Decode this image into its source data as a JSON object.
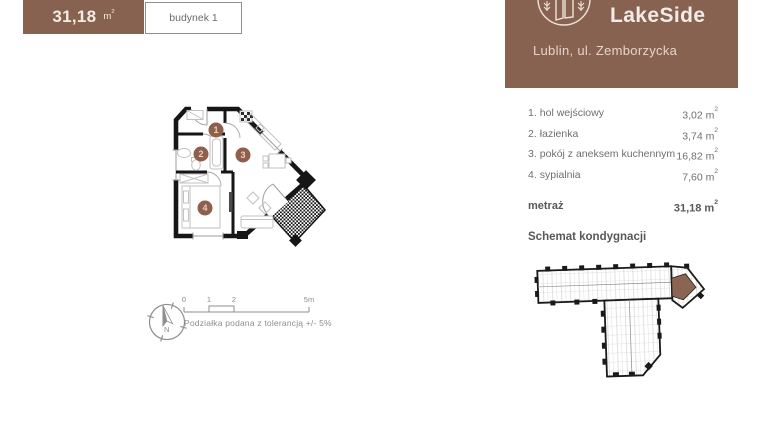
{
  "summary": {
    "area_value": "31,18",
    "unit_base": "m",
    "unit_sup": "2",
    "building_label": "budynek 1"
  },
  "brand": {
    "name": "LakeSide",
    "address": "Lublin, ul. Zemborzycka",
    "logo_icon": "building-with-trees-logo",
    "bg_color": "#876250"
  },
  "rooms": {
    "unit_base": "m",
    "unit_sup": "2",
    "items": [
      {
        "no": "1.",
        "name": "hol wejściowy",
        "area": "3,02"
      },
      {
        "no": "2.",
        "name": "łazienka",
        "area": "3,74"
      },
      {
        "no": "3.",
        "name": "pokój z aneksem kuchennym",
        "area": "16,82"
      },
      {
        "no": "4.",
        "name": "sypialnia",
        "area": "7,60"
      }
    ]
  },
  "total": {
    "label": "metraż",
    "area": "31,18",
    "unit_base": "m",
    "unit_sup": "2"
  },
  "schematic": {
    "title": "Schemat kondygnacji",
    "highlight_color": "#8a6552"
  },
  "floorplan": {
    "markers": [
      "1",
      "2",
      "3",
      "4"
    ],
    "marker_color": "#8d5f4c",
    "scale": {
      "tick_0": "0",
      "tick_1": "1",
      "tick_2": "2",
      "tick_end": "5m",
      "note": "Podziałka podana z tolerancją +/- 5%"
    },
    "compass_label": "N"
  },
  "colors": {
    "brand_brown": "#876250",
    "wall_black": "#161616",
    "text_gray": "#6e6f71"
  }
}
